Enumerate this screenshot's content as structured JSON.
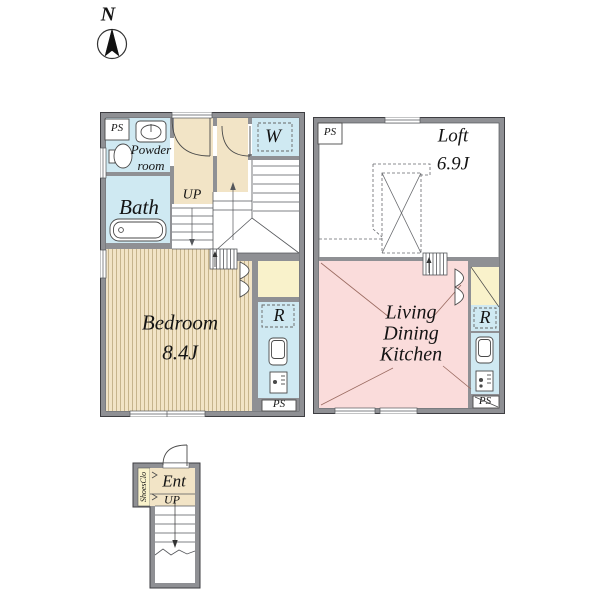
{
  "compass": {
    "label": "N"
  },
  "floor1": {
    "ps_top": "PS",
    "powder_room": "Powder\nroom",
    "bath": "Bath",
    "up": "UP",
    "washer": "W",
    "bedroom": "Bedroom\n8.4J",
    "fridge": "R",
    "ps_bottom": "PS"
  },
  "floor2": {
    "ps_top": "PS",
    "loft": "Loft\n6.9J",
    "ldk": "Living\nDining\nKitchen",
    "fridge": "R",
    "ps_bottom": "PS"
  },
  "entrance": {
    "label": "Ent",
    "up": "UP",
    "shoes_closet": "ShoesClo"
  },
  "colors": {
    "wall_gray": "#8f9094",
    "wet_area_blue": "#cfe9f2",
    "floor_beige": "#f2e4c6",
    "ldk_pink": "#fadcdb",
    "closet_yellow": "#f9f2cb",
    "line_dark": "#4a4a4a",
    "ldk_line_brown": "#9a6a60"
  }
}
